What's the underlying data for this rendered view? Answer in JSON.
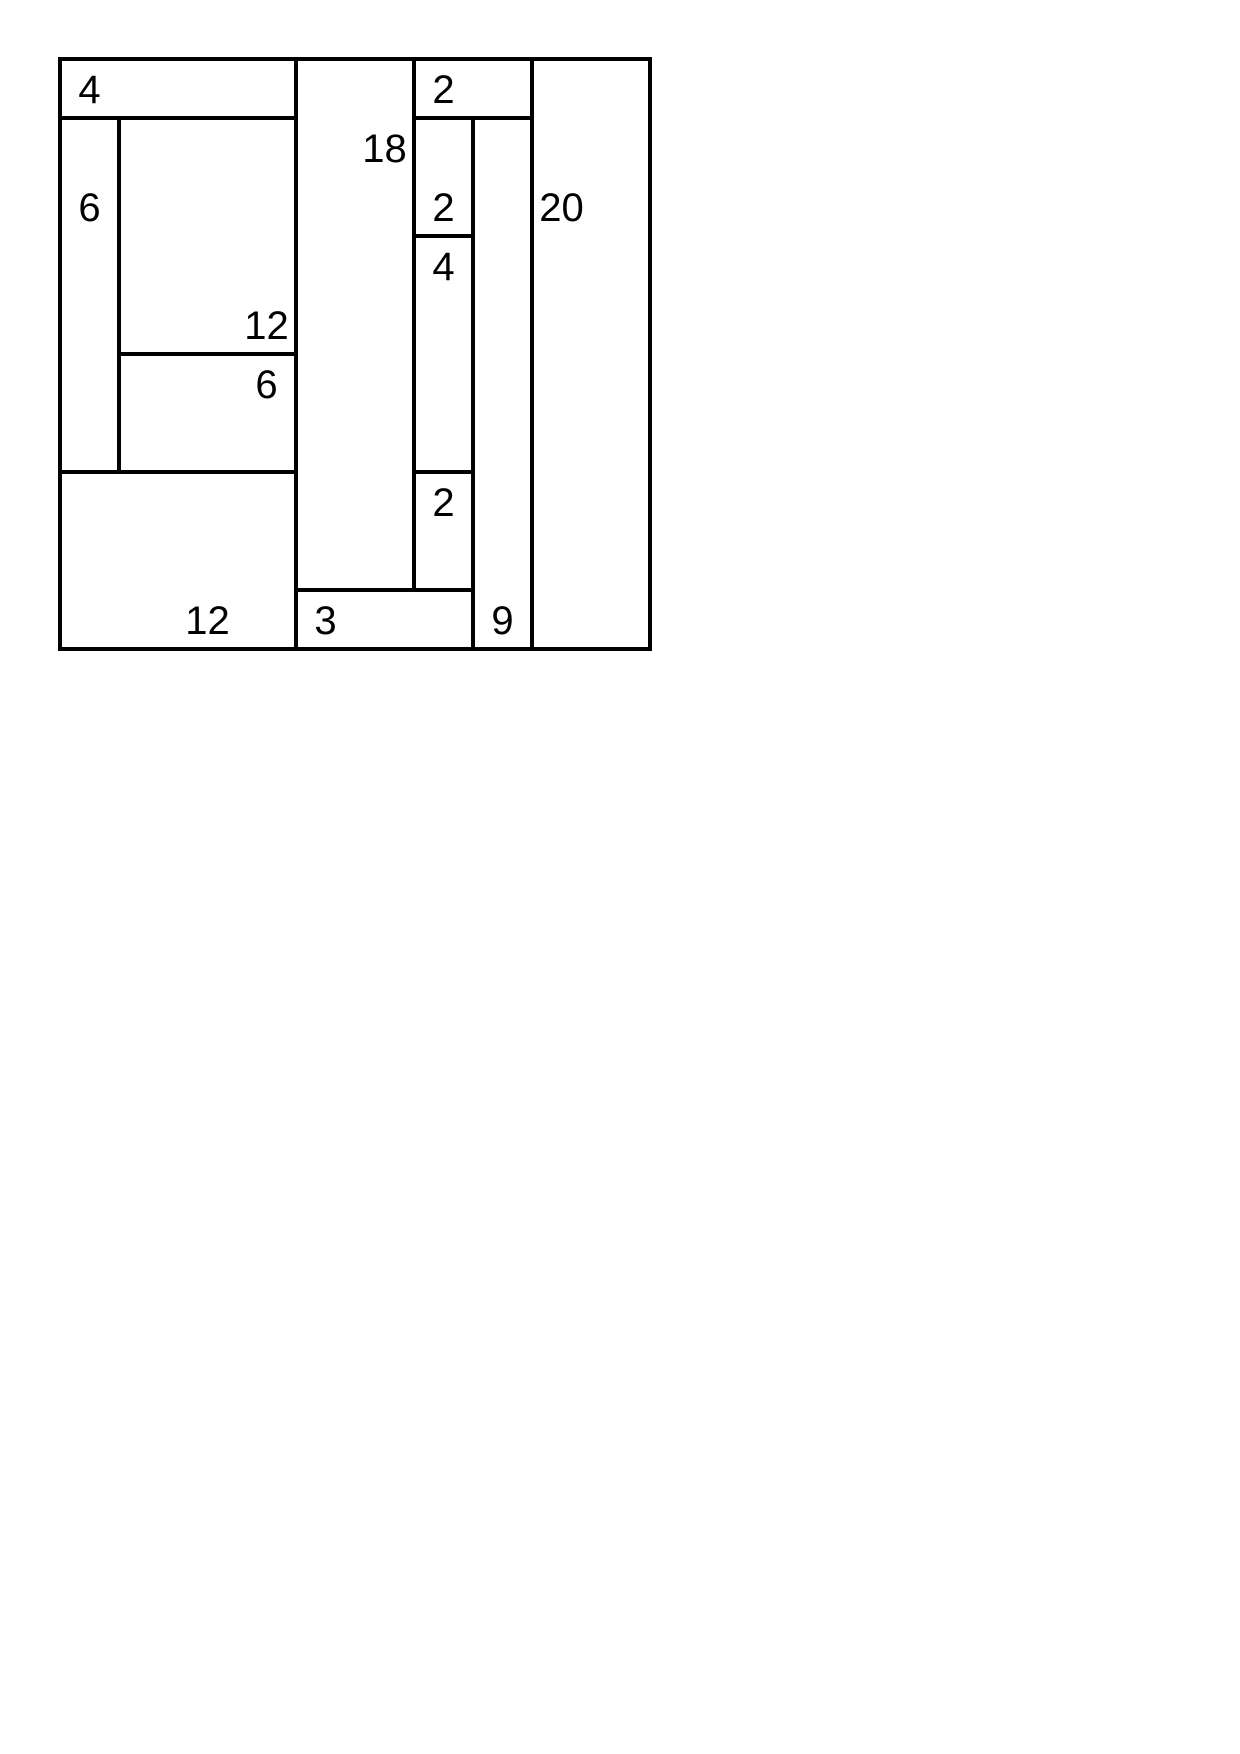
{
  "page": {
    "background": "#ffffff"
  },
  "puzzle": {
    "kind": "shikaku-rectangle-partition",
    "grid_cols": 10,
    "grid_rows": 10,
    "line_color": "#000000",
    "text_color": "#000000",
    "background": "#ffffff",
    "origin_x_px": 60,
    "origin_y_px": 59,
    "cell_size_px": 59,
    "line_width_px": 4,
    "clue_font_px": 40,
    "regions": [
      {
        "value": "4",
        "col": 0,
        "row": 0,
        "w": 4,
        "h": 1,
        "clue_col": 0,
        "clue_row": 0
      },
      {
        "value": "6",
        "col": 0,
        "row": 1,
        "w": 1,
        "h": 6,
        "clue_col": 0,
        "clue_row": 2
      },
      {
        "value": "12",
        "col": 1,
        "row": 1,
        "w": 3,
        "h": 4,
        "clue_col": 3,
        "clue_row": 4
      },
      {
        "value": "6",
        "col": 1,
        "row": 5,
        "w": 3,
        "h": 2,
        "clue_col": 3,
        "clue_row": 5
      },
      {
        "value": "12",
        "col": 0,
        "row": 7,
        "w": 4,
        "h": 3,
        "clue_col": 2,
        "clue_row": 9
      },
      {
        "value": "18",
        "col": 4,
        "row": 0,
        "w": 2,
        "h": 9,
        "clue_col": 5,
        "clue_row": 1
      },
      {
        "value": "2",
        "col": 6,
        "row": 0,
        "w": 2,
        "h": 1,
        "clue_col": 6,
        "clue_row": 0
      },
      {
        "value": "2",
        "col": 6,
        "row": 1,
        "w": 1,
        "h": 2,
        "clue_col": 6,
        "clue_row": 2
      },
      {
        "value": "4",
        "col": 6,
        "row": 3,
        "w": 1,
        "h": 4,
        "clue_col": 6,
        "clue_row": 3
      },
      {
        "value": "2",
        "col": 6,
        "row": 7,
        "w": 1,
        "h": 2,
        "clue_col": 6,
        "clue_row": 7
      },
      {
        "value": "3",
        "col": 4,
        "row": 9,
        "w": 3,
        "h": 1,
        "clue_col": 4,
        "clue_row": 9
      },
      {
        "value": "9",
        "col": 7,
        "row": 1,
        "w": 1,
        "h": 9,
        "clue_col": 7,
        "clue_row": 9
      },
      {
        "value": "20",
        "col": 8,
        "row": 0,
        "w": 2,
        "h": 10,
        "clue_col": 8,
        "clue_row": 2
      }
    ]
  }
}
